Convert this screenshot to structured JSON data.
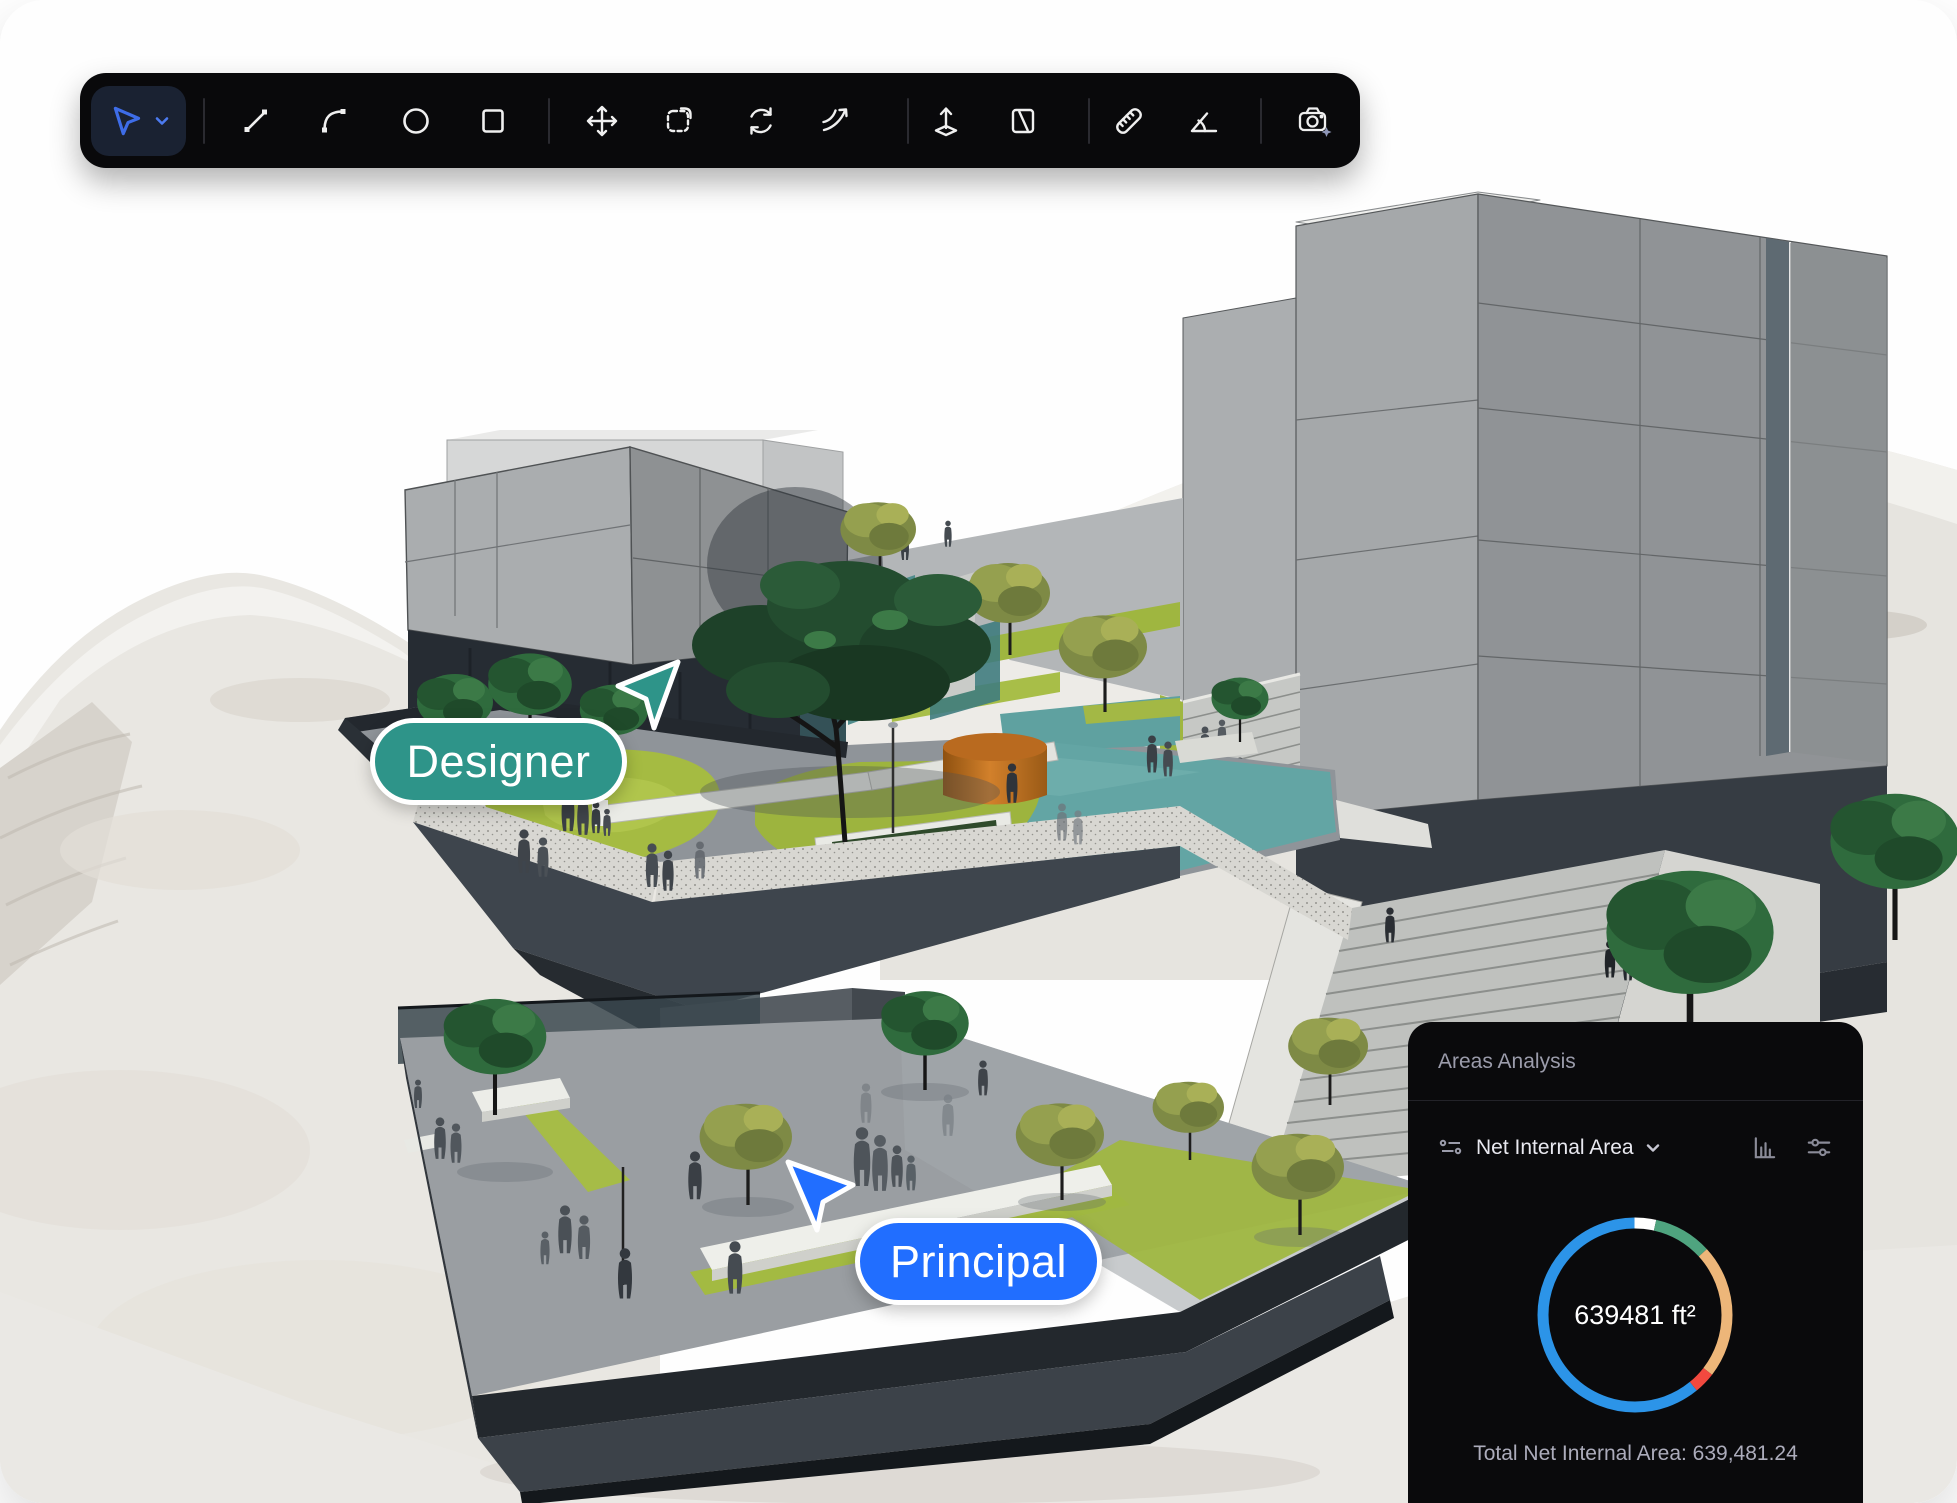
{
  "window": {
    "background": "#ffffff"
  },
  "toolbar": {
    "background": "#09090B",
    "active_tool": "select",
    "accent": "#3E6DE8",
    "tools": [
      {
        "name": "select",
        "icon": "cursor-icon",
        "active": true,
        "has_dropdown": true
      },
      {
        "name": "line",
        "icon": "line-icon",
        "active": false
      },
      {
        "name": "arc",
        "icon": "arc-icon",
        "active": false
      },
      {
        "name": "circle",
        "icon": "circle-icon",
        "active": false
      },
      {
        "name": "rectangle",
        "icon": "rectangle-icon",
        "active": false
      },
      {
        "name": "move",
        "icon": "move-arrows-icon",
        "active": false
      },
      {
        "name": "duplicate",
        "icon": "copy-dashed-icon",
        "active": false
      },
      {
        "name": "rotate",
        "icon": "rotate-icon",
        "active": false
      },
      {
        "name": "offset",
        "icon": "curve-arrow-icon",
        "active": false
      },
      {
        "name": "extrude",
        "icon": "push-pull-icon",
        "active": false
      },
      {
        "name": "section",
        "icon": "section-plane-icon",
        "active": false
      },
      {
        "name": "measure",
        "icon": "ruler-icon",
        "active": false
      },
      {
        "name": "protractor",
        "icon": "angle-icon",
        "active": false
      },
      {
        "name": "render",
        "icon": "camera-sparkle-icon",
        "active": false
      }
    ]
  },
  "scene": {
    "labels": {
      "designer": "Designer",
      "principal": "Principal"
    },
    "colors": {
      "designer": "#2E9489",
      "principal": "#216EFF",
      "pool": "#63A5A4",
      "lawn": "#A5BB42",
      "building": "#A5A8AA",
      "terrain": "#E9E7E2"
    }
  },
  "panel": {
    "title": "Areas Analysis",
    "metric_label": "Net Internal Area",
    "icons": [
      "list-settings-icon",
      "chevron-down-icon",
      "bar-chart-icon",
      "filters-icon"
    ],
    "total": "Total Net Internal Area: 639,481.24"
  },
  "chart_data": {
    "type": "donut",
    "center_label": "639481 ft²",
    "total_value": "639,481.24",
    "unit": "ft²",
    "legend": false,
    "start_angle_deg": 0,
    "segments": [
      {
        "color": "#FFFFFF",
        "percent": 3.6
      },
      {
        "color": "#4FA47F",
        "percent": 9.7
      },
      {
        "color": "#EDB679",
        "percent": 22.2
      },
      {
        "color": "#F2493F",
        "percent": 3.6
      },
      {
        "color": "#2C94E8",
        "percent": 60.9
      }
    ]
  }
}
